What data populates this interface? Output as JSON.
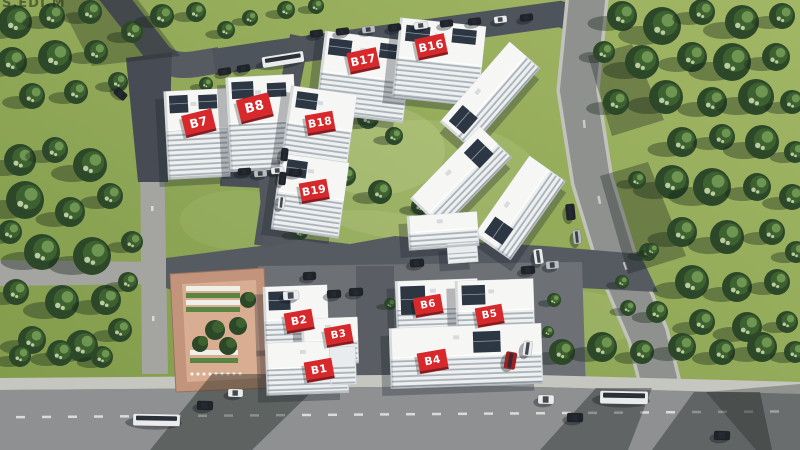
{
  "watermark": "S.EDI.M",
  "colors": {
    "sign_red": "#d7282c",
    "sign_red_dark": "#8e181b",
    "sign_text": "#ffffff",
    "grass_light": "#a2b765",
    "grass_dark": "#7f9a4a",
    "road_main": "#8e9092",
    "asphalt_dark": "#51565d",
    "building": "#e9ecee",
    "tree": "#2c4829",
    "courtyard": "#c2947c"
  },
  "buildings": [
    {
      "id": "B7",
      "label": "B7",
      "x": 166,
      "y": 90,
      "w": 62,
      "h": 88,
      "rot": -3,
      "stripe_from": 0.45,
      "glass": [
        [
          0.08,
          0.05,
          0.3,
          0.2
        ],
        [
          0.55,
          0.06,
          0.3,
          0.16
        ]
      ],
      "sign": {
        "x": 183,
        "y": 112,
        "w": 31,
        "h": 20,
        "rot": -14
      }
    },
    {
      "id": "B8",
      "label": "B8",
      "x": 228,
      "y": 76,
      "w": 68,
      "h": 94,
      "rot": -3,
      "stripe_from": 0.5,
      "glass": [
        [
          0.08,
          0.05,
          0.32,
          0.18
        ],
        [
          0.6,
          0.08,
          0.28,
          0.15
        ]
      ],
      "sign": {
        "x": 238,
        "y": 96,
        "w": 33,
        "h": 22,
        "rot": -14
      }
    },
    {
      "id": "B17",
      "label": "B17",
      "x": 320,
      "y": 36,
      "w": 88,
      "h": 82,
      "rot": 7,
      "stripe_from": 0.5,
      "glass": [
        [
          0.06,
          0.08,
          0.26,
          0.2
        ],
        [
          0.64,
          0.06,
          0.28,
          0.18
        ]
      ],
      "sign": {
        "x": 348,
        "y": 50,
        "w": 30,
        "h": 19,
        "rot": -12
      }
    },
    {
      "id": "B16",
      "label": "B16",
      "x": 396,
      "y": 22,
      "w": 86,
      "h": 80,
      "rot": 6,
      "stripe_from": 0.5,
      "glass": [
        [
          0.08,
          0.08,
          0.28,
          0.2
        ],
        [
          0.62,
          0.06,
          0.28,
          0.18
        ]
      ],
      "sign": {
        "x": 416,
        "y": 36,
        "w": 30,
        "h": 19,
        "rot": -12
      }
    },
    {
      "id": "B18",
      "label": "B18",
      "x": 286,
      "y": 90,
      "w": 66,
      "h": 74,
      "rot": 8,
      "stripe_from": 0.5,
      "glass": [
        [
          0.1,
          0.06,
          0.32,
          0.22
        ]
      ],
      "sign": {
        "x": 306,
        "y": 113,
        "w": 28,
        "h": 18,
        "rot": -10
      }
    },
    {
      "id": "B19",
      "label": "B19",
      "x": 276,
      "y": 158,
      "w": 68,
      "h": 76,
      "rot": 8,
      "stripe_from": 0.5,
      "glass": [
        [
          0.1,
          0.06,
          0.3,
          0.22
        ]
      ],
      "sign": {
        "x": 300,
        "y": 181,
        "w": 28,
        "h": 18,
        "rot": -10
      }
    },
    {
      "id": "S1",
      "label": null,
      "x": 437,
      "y": 75,
      "w": 106,
      "h": 40,
      "rot": -49,
      "stripe_from": 0.55,
      "glass": [
        [
          0.06,
          0.15,
          0.2,
          0.5
        ]
      ]
    },
    {
      "id": "S2",
      "label": null,
      "x": 411,
      "y": 156,
      "w": 100,
      "h": 44,
      "rot": -46,
      "stripe_from": 0.55,
      "glass": [
        [
          0.7,
          0.15,
          0.2,
          0.5
        ]
      ]
    },
    {
      "id": "S3",
      "label": null,
      "x": 472,
      "y": 186,
      "w": 96,
      "h": 44,
      "rot": -55,
      "stripe_from": 0.55,
      "glass": [
        [
          0.08,
          0.15,
          0.2,
          0.5
        ]
      ]
    },
    {
      "id": "S4",
      "label": null,
      "x": 408,
      "y": 214,
      "w": 70,
      "h": 34,
      "rot": -4,
      "stripe_from": 0.5,
      "glass": [],
      "wing": [
        446,
        244,
        30,
        20
      ]
    },
    {
      "id": "B2",
      "label": "B2",
      "x": 264,
      "y": 286,
      "w": 64,
      "h": 62,
      "rot": -2,
      "stripe_from": 0.55,
      "glass": [
        [
          0.08,
          0.08,
          0.34,
          0.3
        ]
      ],
      "sign": {
        "x": 285,
        "y": 311,
        "w": 28,
        "h": 18,
        "rot": -10
      }
    },
    {
      "id": "B3",
      "label": "B3",
      "x": 302,
      "y": 318,
      "w": 56,
      "h": 46,
      "rot": -2,
      "stripe_from": 0.5,
      "glass": [],
      "sign": {
        "x": 325,
        "y": 326,
        "w": 27,
        "h": 17,
        "rot": -10
      }
    },
    {
      "id": "B1",
      "label": "B1",
      "x": 266,
      "y": 342,
      "w": 82,
      "h": 52,
      "rot": -2,
      "stripe_from": 0.5,
      "glass": [],
      "wing": [
        330,
        348,
        26,
        38
      ],
      "sign": {
        "x": 305,
        "y": 360,
        "w": 28,
        "h": 18,
        "rot": -10
      }
    },
    {
      "id": "B6",
      "label": "B6",
      "x": 396,
      "y": 280,
      "w": 82,
      "h": 52,
      "rot": -2,
      "stripe_from": 0.55,
      "glass": [
        [
          0.06,
          0.1,
          0.3,
          0.55
        ]
      ],
      "sign": {
        "x": 414,
        "y": 296,
        "w": 28,
        "h": 17,
        "rot": -10
      }
    },
    {
      "id": "B5",
      "label": "B5",
      "x": 456,
      "y": 280,
      "w": 78,
      "h": 56,
      "rot": -2,
      "stripe_from": 0.55,
      "glass": [
        [
          0.08,
          0.08,
          0.3,
          0.35
        ]
      ],
      "sign": {
        "x": 476,
        "y": 306,
        "w": 27,
        "h": 17,
        "rot": -10
      }
    },
    {
      "id": "B4",
      "label": "B4",
      "x": 390,
      "y": 326,
      "w": 152,
      "h": 60,
      "rot": -2,
      "stripe_from": 0.5,
      "glass": [
        [
          0.55,
          0.1,
          0.18,
          0.35
        ]
      ],
      "sign": {
        "x": 418,
        "y": 351,
        "w": 29,
        "h": 18,
        "rot": -10
      }
    }
  ]
}
